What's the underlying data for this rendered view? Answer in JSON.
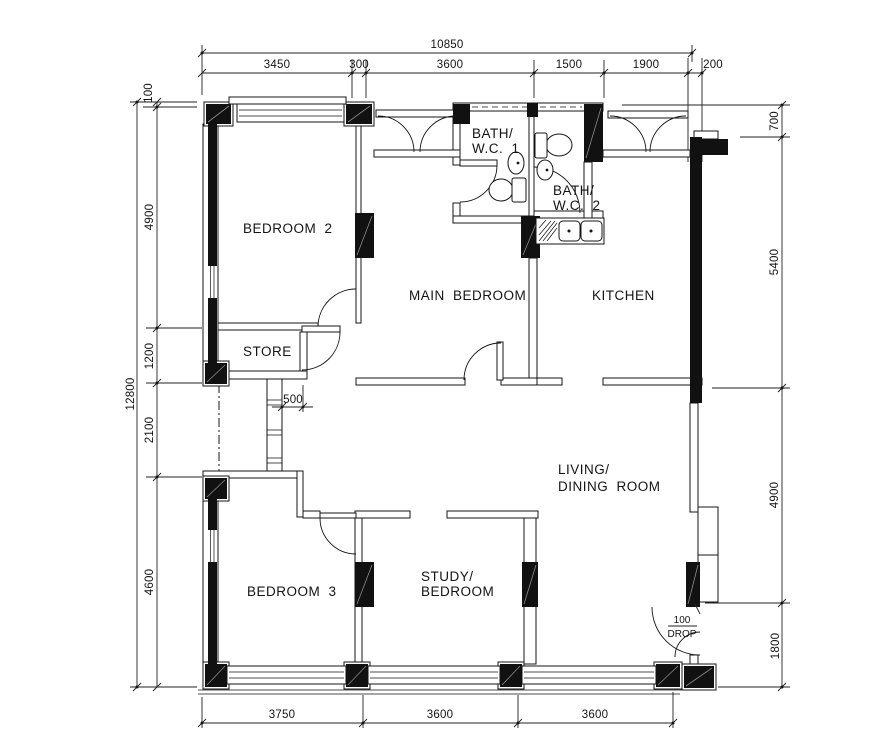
{
  "title": "floor-plan",
  "colors": {
    "ink": "#141414",
    "background": "#ffffff"
  },
  "rooms": {
    "bedroom2": {
      "label": "BEDROOM 2"
    },
    "store": {
      "label": "STORE"
    },
    "main_bedroom": {
      "label": "MAIN BEDROOM"
    },
    "bath1": {
      "line1": "BATH/",
      "line2": "W.C. 1"
    },
    "bath2": {
      "line1": "BATH/",
      "line2": "W.C. 2"
    },
    "kitchen": {
      "label": "KITCHEN"
    },
    "living": {
      "line1": "LIVING/",
      "line2": "DINING ROOM"
    },
    "bedroom3": {
      "label": "BEDROOM 3"
    },
    "study": {
      "line1": "STUDY/",
      "line2": "BEDROOM"
    }
  },
  "annotations": {
    "corridor_width": "500",
    "entrance_drop_value": "100",
    "entrance_drop_word": "DROP"
  },
  "dimensions": {
    "top": {
      "total": "10850",
      "segments": [
        "3450",
        "300",
        "3600",
        "1500",
        "1900",
        "200"
      ]
    },
    "left": {
      "total": "12800",
      "segments": [
        "100",
        "4900",
        "1200",
        "2100",
        "4600"
      ]
    },
    "right": {
      "segments": [
        "700",
        "5400",
        "4900",
        "1800"
      ]
    },
    "bottom": {
      "segments": [
        "3750",
        "3600",
        "3600"
      ]
    }
  }
}
